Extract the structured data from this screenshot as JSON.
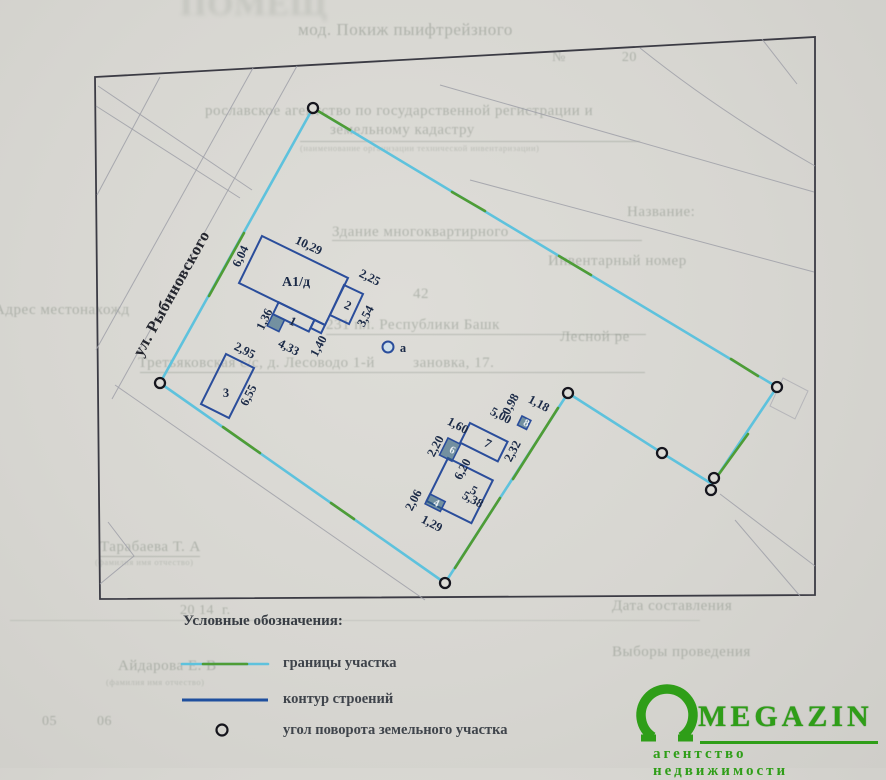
{
  "document": {
    "street_label": "ул. Рыбиновского",
    "point_a_label": "а",
    "buildings": {
      "a1d": "А1/д",
      "n1": "1",
      "n2": "2",
      "n3": "3",
      "n4": "4",
      "n5": "5",
      "n6": "6",
      "n7": "7",
      "n8": "8"
    },
    "dims": [
      "10,29",
      "6,04",
      "2,25",
      "3,54",
      "1,36",
      "4,33",
      "1,40",
      "2,95",
      "6,55",
      "1,60",
      "2,20",
      "5,00",
      "0,98",
      "1,18",
      "2,32",
      "6,20",
      "5,38",
      "2,06",
      "1,29"
    ],
    "legend": {
      "title": "Условные обозначения:",
      "items": [
        {
          "label": "границы участка"
        },
        {
          "label": "контур строений"
        },
        {
          "label": "угол поворота земельного участка"
        }
      ]
    }
  },
  "watermark": {
    "brand": "MEGAZIN",
    "tagline": "агентство недвижимости"
  },
  "colors": {
    "boundary_cyan": "#5ec2dd",
    "boundary_green": "#4f9c35",
    "contour_blue": "#2a4d9b",
    "logo_green": "#2f9e18"
  },
  "bleedthrough": [
    "мод. Покиж пыифтрейзного",
    "№              20",
    "рославское агентство по государственной регистрации и",
    "земельному кадастру",
    "(наименование организации технической инвентаризации)",
    "Здание многоквартирного",
    "Название:",
    "Инвентарный номер",
    "42",
    "Адрес местонахожд",
    "231 пл. Республики Башк",
    "Лесной ре",
    "Третьяковская с/с, д. Лесоводо 1-й         зановка, 17.",
    "Тарабаева Т. А",
    "(фамилия имя отчество)",
    "Дата составления",
    "20 14  г.",
    "Выборы проведения",
    "Айдарова Е. В",
    "(фамилия имя отчество)",
    "05          06",
    "ПОМЕЩ"
  ]
}
